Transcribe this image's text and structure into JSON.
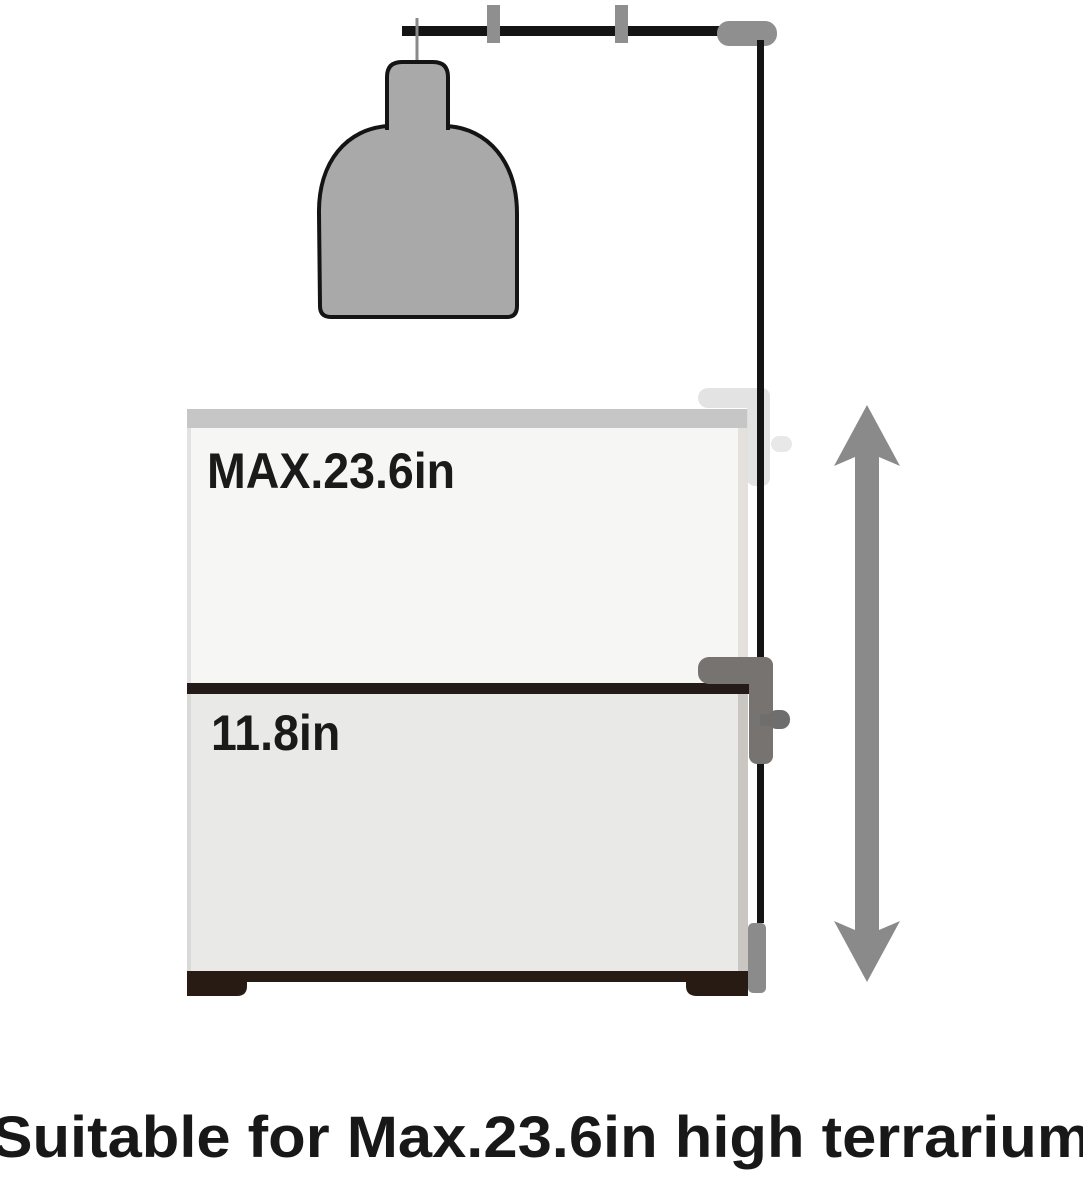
{
  "diagram": {
    "title": "terrarium-lamp-stand-height-diagram",
    "terrarium": {
      "max_height_label": "MAX.23.6in",
      "base_height_label": "11.8in"
    },
    "caption": "Suitable for Max.23.6in high terrarium",
    "icons": {
      "lamp": "hanging-dome-lamp-icon",
      "stand_arm": "overhead-stand-arm-icon",
      "stand_pole": "vertical-stand-pole-icon",
      "clamp_upper": "clamp-max-position-ghost-icon",
      "clamp_lower": "clamp-mounted-icon",
      "arrow": "vertical-double-arrow-icon"
    },
    "colors": {
      "lamp_gray": "#a9a9a9",
      "outline_black": "#141414",
      "stand_gray": "#8f8f8f",
      "arrow_gray": "#8a8a8a",
      "clamp_dark_gray": "#767370",
      "clamp_light_gray": "#e1e1e1",
      "box_top_band": "#c6c6c6",
      "upper_box_fill": "#f6f6f4",
      "lower_box_fill": "#e9e9e7",
      "divider_dark": "#241b18",
      "base_dark": "#281b14",
      "text_black": "#181818"
    }
  }
}
